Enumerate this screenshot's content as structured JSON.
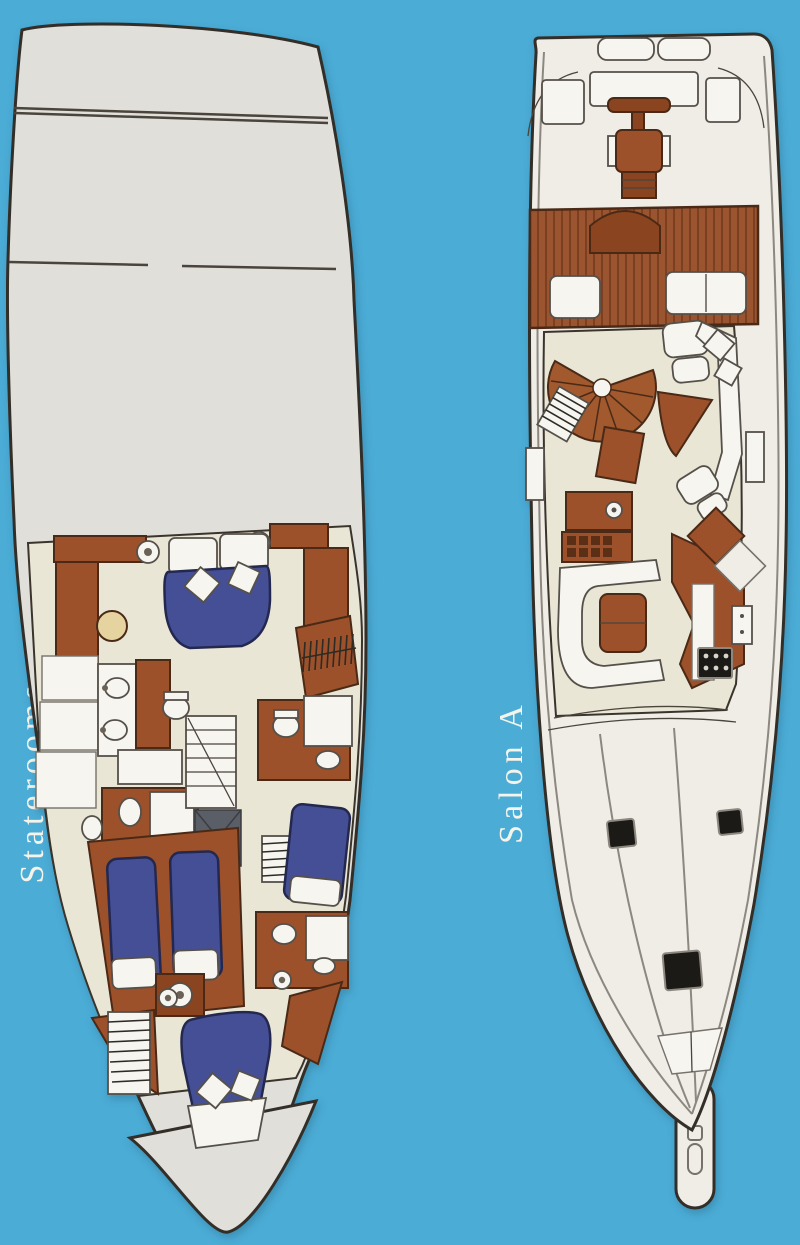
{
  "page": {
    "type": "yacht deck plan brochure page",
    "background_color": "#4BACD6"
  },
  "plans": [
    {
      "id": "staterooms",
      "label": "Staterooms",
      "features": [
        "aft-deck",
        "master-stateroom-queen-bed",
        "stereo-speakers",
        "master-bathroom-double-sink",
        "guest-bathroom",
        "shower",
        "companionway-stairs",
        "hanging-locker",
        "twin-bed-stateroom",
        "starboard-guest-stateroom",
        "forward-vip-v-berth",
        "bow-deck"
      ]
    },
    {
      "id": "salon-a",
      "label": "Salon A",
      "features": [
        "transom-hatches",
        "cockpit-hatches",
        "fighting-chair",
        "teak-cockpit-deck",
        "mezzanine-benches",
        "spiral-staircase",
        "companionway-steps",
        "armchair-with-ottoman",
        "sofa",
        "coffee-table",
        "wet-bar",
        "drawer-sideboard",
        "u-shaped-dinette",
        "dinette-table",
        "galley-counter",
        "cooktop",
        "refrigerator",
        "side-deck-gates",
        "foredeck-hatches",
        "anchor-locker",
        "bow-pulpit"
      ]
    }
  ],
  "palette": {
    "background": "#4BACD6",
    "deck_gray": "#E0DFD9",
    "deck_white": "#EFEDE6",
    "floor_cream": "#E9E6D6",
    "wood_brown": "#9C512B",
    "bed_navy": "#454F96",
    "outline_dark": "#332E28",
    "hatch_black": "#1C1A16",
    "label_text": "#F5F3EA",
    "table_tan": "#E5D3A0"
  }
}
